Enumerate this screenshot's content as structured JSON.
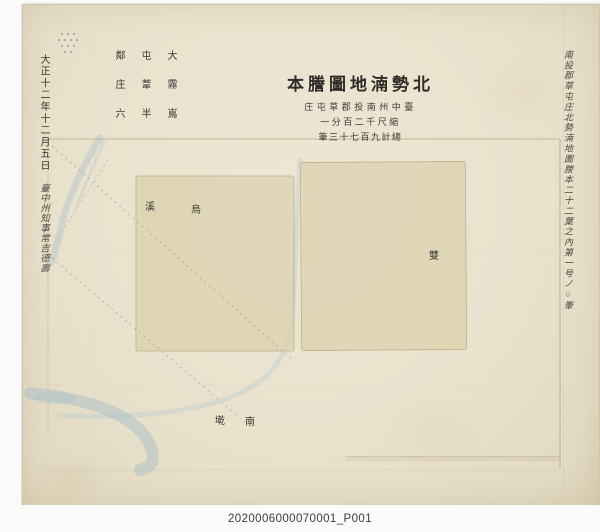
{
  "caption": "2020006000070001_P001",
  "map": {
    "title": {
      "reading": "北勢湳地圖謄本",
      "display": "本謄圖地湳勢北"
    },
    "subtitles": [
      {
        "reading": "臺中州南投郡草屯庄",
        "display": "庄屯草郡投南州中臺"
      },
      {
        "reading": "縮尺千二百分一",
        "display": "一分百二千尺縮"
      },
      {
        "reading": "總計九百七十三筆",
        "display": "筆三十七百九計總"
      }
    ],
    "corner_note_columns": [
      "大霧嶌",
      "屯葦半",
      "鄰庄六"
    ],
    "date_line": "大正十二年十二月五日",
    "signature_line": "臺中州知事常吉德壽",
    "right_margin_note": "南投郡草屯庄北勢湳地圖謄本二十二葉之內第一号ノ○筆",
    "place_labels": [
      "溪",
      "烏",
      "雙",
      "墘",
      "南"
    ],
    "colors": {
      "paper": "#e9e2cd",
      "parcel": "#dbd1ad",
      "river": "#aec2ca",
      "ink": "#3b3733",
      "caption_text": "#3c3c3c"
    }
  }
}
